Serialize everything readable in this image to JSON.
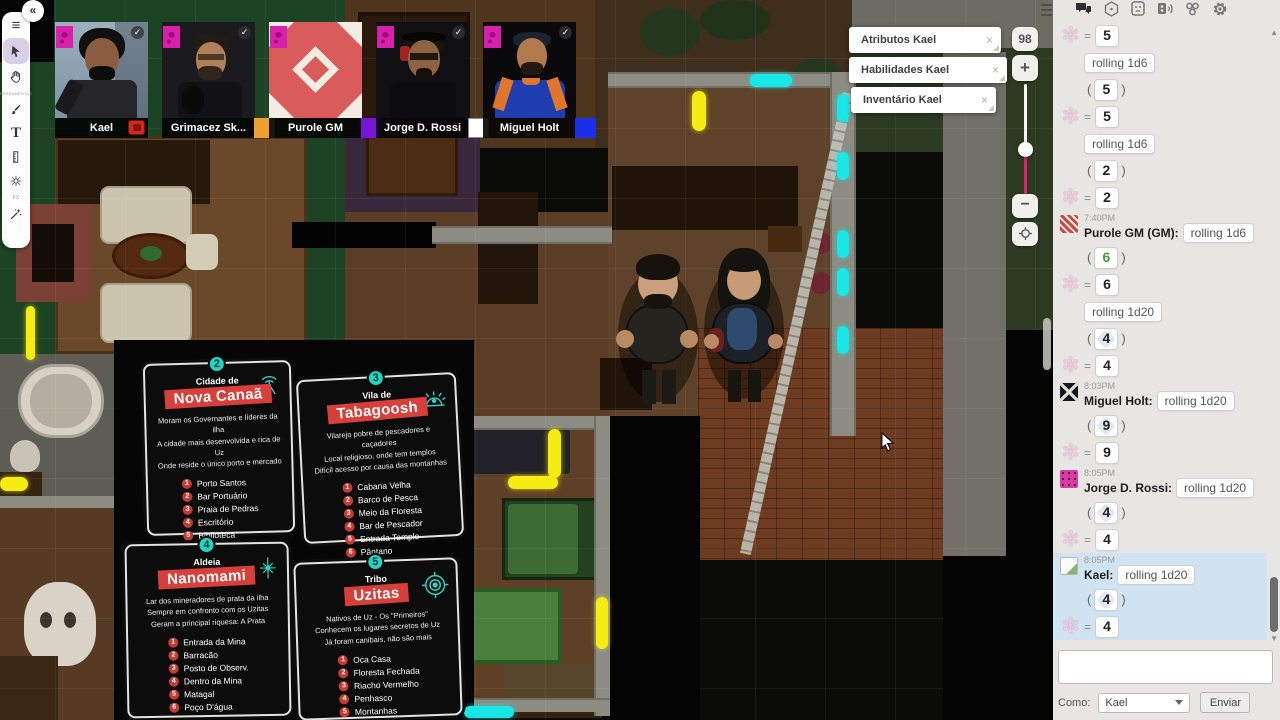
{
  "toolbar": {
    "tools_label": "FERRAMENTAS",
    "fx_label": "FX"
  },
  "videos": [
    {
      "name": "Kael",
      "color": "#cf2b25"
    },
    {
      "name": "Grimacez Sk...",
      "color": "#efa02f"
    },
    {
      "name": "Purole GM",
      "color": "#7b16d9"
    },
    {
      "name": "Jorge D. Rossi",
      "color": "#ffffff"
    },
    {
      "name": "Miguel Holt",
      "color": "#1b2fe8"
    }
  ],
  "popups": [
    {
      "title": "Atributos Kael",
      "close": "×"
    },
    {
      "title": "Habilidades Kael",
      "close": "×"
    },
    {
      "title": "Inventário Kael",
      "close": "×"
    }
  ],
  "zoom": {
    "value": "98",
    "plus": "+",
    "minus": "−"
  },
  "cards": [
    {
      "number": "2",
      "pretitle": "Cidade de",
      "title": "Nova Canaã",
      "icon": "antenna",
      "desc": [
        "Moram os Governantes e líderes da ilha",
        "A cidade mais desenvolvida e rica de Uz",
        "Onde reside o único porto e mercado"
      ],
      "items": [
        "Porto Santos",
        "Bar Portuário",
        "Praia de Pedras",
        "Escritório",
        "Biblioteca",
        "Antiquário"
      ]
    },
    {
      "number": "3",
      "pretitle": "Vila de",
      "title": "Tabagoosh",
      "icon": "dome",
      "desc": [
        "Vilarejo pobre de pescadores e caçadores",
        "Local religioso, onde tem templos",
        "Difícil acesso por causa das montanhas"
      ],
      "items": [
        "Cabana Velha",
        "Barco de Pesca",
        "Meio da Floresta",
        "Bar de Pescador",
        "Entrada Templo",
        "Pântano"
      ]
    },
    {
      "number": "4",
      "pretitle": "Aldeia",
      "title": "Nanomami",
      "icon": "star",
      "desc": [
        "Lar dos mineradores de prata da ilha",
        "Sempre em confronto com os Uzitas",
        "Geram a principal riquesa: A Prata"
      ],
      "items": [
        "Entrada da Mina",
        "Barracão",
        "Posto de Observ.",
        "Dentro da Mina",
        "Matagal",
        "Poço D'água"
      ]
    },
    {
      "number": "5",
      "pretitle": "Tribo",
      "title": "Uzitas",
      "icon": "target",
      "desc": [
        "Nativos de Uz - Os \"Primeiros\"",
        "Conhecem os lugares secretos de Uz",
        "Já foram canibais, não são mais"
      ],
      "items": [
        "Oca Casa",
        "Floresta Fechada",
        "Riacho Vermelho",
        "Penhasco",
        "Montanhas",
        "Entrada da Gruta"
      ]
    }
  ],
  "chat": {
    "messages": [
      {
        "kind": "result",
        "value": "5"
      },
      {
        "kind": "roll",
        "text": "rolling 1d6"
      },
      {
        "kind": "paren",
        "value": "5",
        "die": "d6"
      },
      {
        "kind": "result",
        "value": "5"
      },
      {
        "kind": "roll",
        "text": "rolling 1d6"
      },
      {
        "kind": "paren",
        "value": "2",
        "die": "d6"
      },
      {
        "kind": "result",
        "value": "2"
      },
      {
        "kind": "header",
        "time": "7:40PM",
        "name": "Purole GM (GM):",
        "roll": "rolling 1d6",
        "avatar": "purole"
      },
      {
        "kind": "paren",
        "value": "6",
        "die": "d6",
        "max": true
      },
      {
        "kind": "result",
        "value": "6"
      },
      {
        "kind": "roll",
        "text": "rolling 1d20"
      },
      {
        "kind": "paren",
        "value": "4",
        "die": "d20"
      },
      {
        "kind": "result",
        "value": "4"
      },
      {
        "kind": "header",
        "time": "8:03PM",
        "name": "Miguel Holt:",
        "roll": "rolling 1d20",
        "avatar": "miguel"
      },
      {
        "kind": "paren",
        "value": "9",
        "die": "d20"
      },
      {
        "kind": "result",
        "value": "9"
      },
      {
        "kind": "header",
        "time": "8:05PM",
        "name": "Jorge D. Rossi:",
        "roll": "rolling 1d20",
        "avatar": "jorge"
      },
      {
        "kind": "paren",
        "value": "4",
        "die": "d20"
      },
      {
        "kind": "result",
        "value": "4"
      },
      {
        "kind": "header",
        "time": "8:05PM",
        "name": "Kael:",
        "roll": "rolling 1d20",
        "avatar": "kael",
        "hl": true
      },
      {
        "kind": "paren",
        "value": "4",
        "die": "d20",
        "hl": true
      },
      {
        "kind": "result",
        "value": "4",
        "hl": true
      }
    ],
    "input": {
      "as_label": "Como:",
      "as_value": "Kael",
      "send_label": "Enviar"
    }
  }
}
